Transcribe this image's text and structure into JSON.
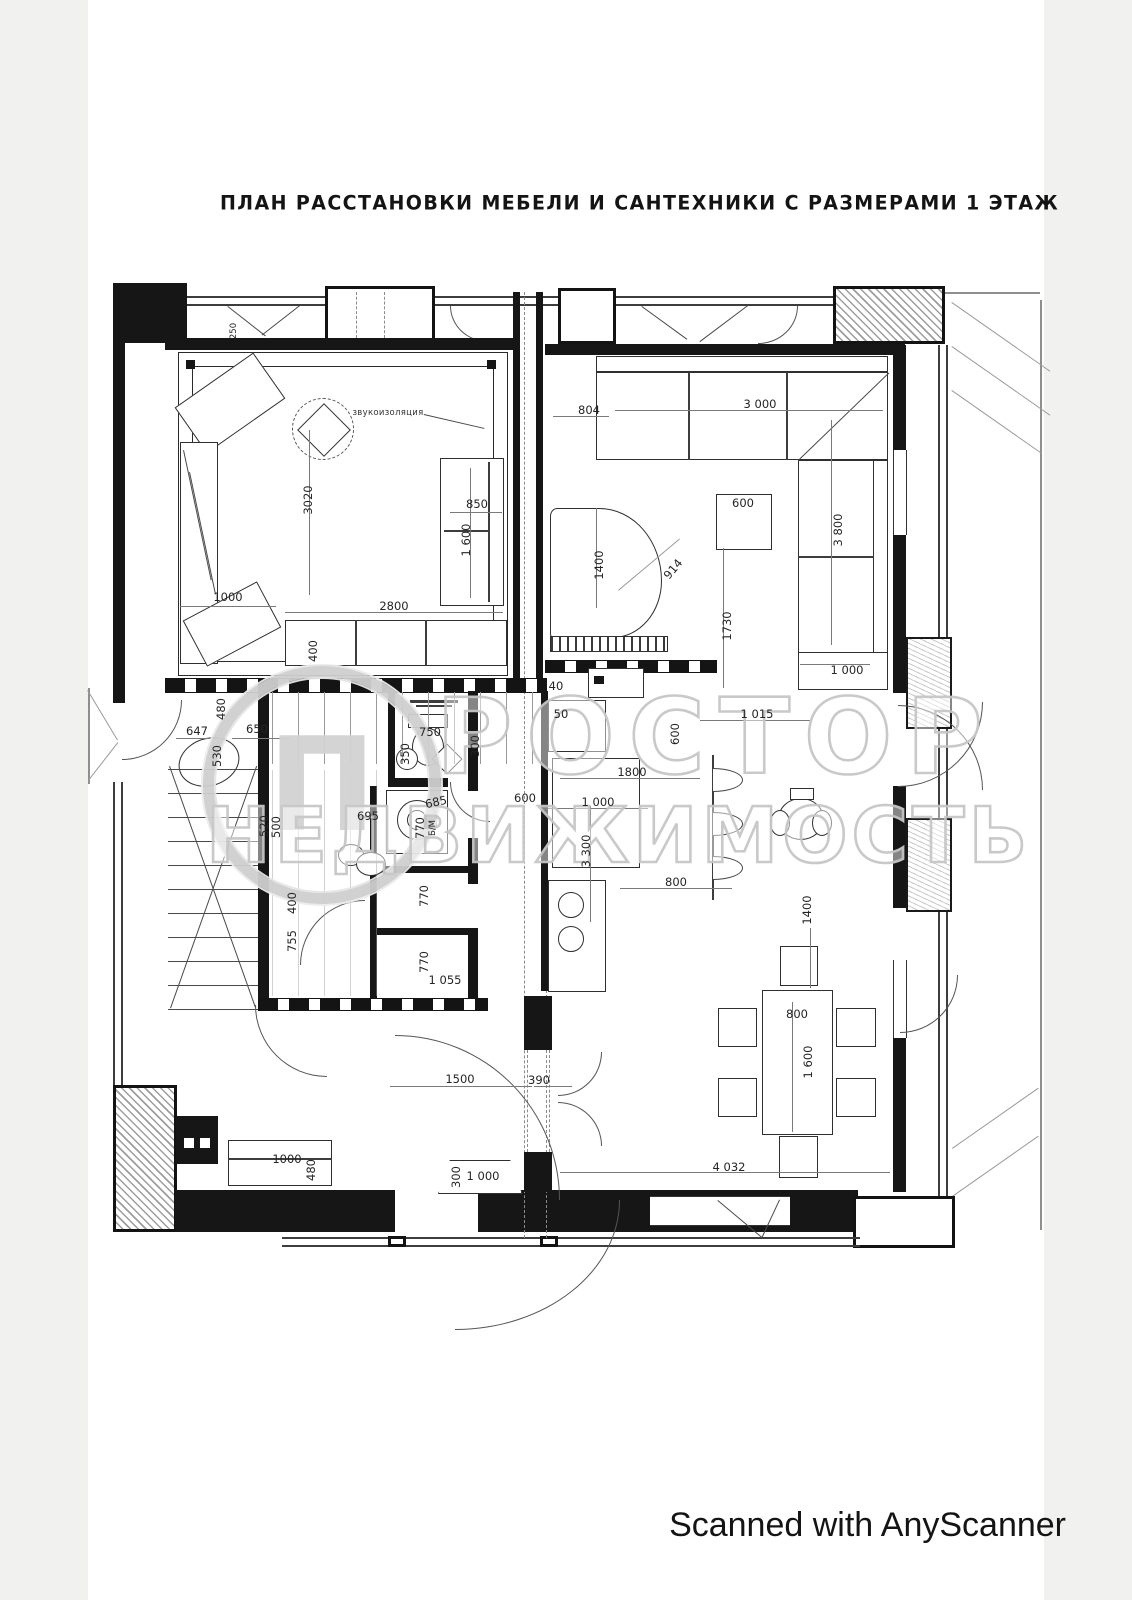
{
  "page": {
    "title": "ПЛАН РАССТАНОВКИ МЕБЕЛИ И САНТЕХНИКИ С РАЗМЕРАМИ 1 ЭТАЖ",
    "footer": "Scanned with AnyScanner"
  },
  "watermark": {
    "brand": "ПРОСТОР НЕДВИЖИМОСТЬ",
    "logo_letter": "П",
    "line1": "РОСТОР",
    "line2": "НЕДВИЖИМОСТЬ"
  },
  "plan": {
    "floor_note": "1 ЭТАЖ",
    "labels": [
      {
        "t": "250",
        "x": 234,
        "y": 331,
        "r": -90,
        "cls": "sm"
      },
      {
        "t": "звукоизоляция",
        "x": 388,
        "y": 413,
        "r": 0,
        "cls": "note"
      },
      {
        "t": "3020",
        "x": 308,
        "y": 500,
        "r": -90
      },
      {
        "t": "1000",
        "x": 228,
        "y": 597,
        "r": 0
      },
      {
        "t": "2800",
        "x": 394,
        "y": 606,
        "r": 0
      },
      {
        "t": "850",
        "x": 477,
        "y": 504,
        "r": 0
      },
      {
        "t": "1 600",
        "x": 466,
        "y": 540,
        "r": -90
      },
      {
        "t": "400",
        "x": 313,
        "y": 651,
        "r": -90
      },
      {
        "t": "804",
        "x": 589,
        "y": 410,
        "r": 0
      },
      {
        "t": "3 000",
        "x": 760,
        "y": 404,
        "r": 0
      },
      {
        "t": "600",
        "x": 743,
        "y": 503,
        "r": 0
      },
      {
        "t": "3 800",
        "x": 838,
        "y": 530,
        "r": -90
      },
      {
        "t": "1400",
        "x": 599,
        "y": 565,
        "r": -90
      },
      {
        "t": "914",
        "x": 673,
        "y": 569,
        "r": -50
      },
      {
        "t": "1730",
        "x": 727,
        "y": 626,
        "r": -90
      },
      {
        "t": "1 000",
        "x": 847,
        "y": 670,
        "r": 0
      },
      {
        "t": "40",
        "x": 556,
        "y": 686,
        "r": 0
      },
      {
        "t": "50",
        "x": 561,
        "y": 714,
        "r": 0
      },
      {
        "t": "1 015",
        "x": 757,
        "y": 714,
        "r": 0
      },
      {
        "t": "647",
        "x": 197,
        "y": 731,
        "r": 0
      },
      {
        "t": "480",
        "x": 221,
        "y": 709,
        "r": -90
      },
      {
        "t": "650",
        "x": 257,
        "y": 729,
        "r": 0
      },
      {
        "t": "530",
        "x": 217,
        "y": 756,
        "r": -90
      },
      {
        "t": "750",
        "x": 430,
        "y": 732,
        "r": 0
      },
      {
        "t": "350",
        "x": 405,
        "y": 754,
        "r": -90
      },
      {
        "t": "300",
        "x": 475,
        "y": 746,
        "r": -90
      },
      {
        "t": "600",
        "x": 525,
        "y": 798,
        "r": 0
      },
      {
        "t": "685",
        "x": 436,
        "y": 802,
        "r": -12
      },
      {
        "t": "770",
        "x": 420,
        "y": 828,
        "r": -90
      },
      {
        "t": "Б/М",
        "x": 433,
        "y": 828,
        "r": -90,
        "cls": "sm"
      },
      {
        "t": "695",
        "x": 368,
        "y": 816,
        "r": 0
      },
      {
        "t": "520",
        "x": 264,
        "y": 826,
        "r": -90
      },
      {
        "t": "500",
        "x": 276,
        "y": 827,
        "r": -90
      },
      {
        "t": "600",
        "x": 675,
        "y": 734,
        "r": -90
      },
      {
        "t": "1800",
        "x": 632,
        "y": 772,
        "r": 0
      },
      {
        "t": "1 000",
        "x": 598,
        "y": 802,
        "r": 0
      },
      {
        "t": "3 300",
        "x": 586,
        "y": 851,
        "r": -90
      },
      {
        "t": "800",
        "x": 676,
        "y": 882,
        "r": 0
      },
      {
        "t": "1400",
        "x": 807,
        "y": 910,
        "r": -90
      },
      {
        "t": "400",
        "x": 292,
        "y": 903,
        "r": -90
      },
      {
        "t": "755",
        "x": 292,
        "y": 941,
        "r": -90
      },
      {
        "t": "770",
        "x": 424,
        "y": 896,
        "r": -90
      },
      {
        "t": "770",
        "x": 424,
        "y": 962,
        "r": -90
      },
      {
        "t": "1 055",
        "x": 445,
        "y": 980,
        "r": 0
      },
      {
        "t": "800",
        "x": 797,
        "y": 1014,
        "r": 0
      },
      {
        "t": "1 600",
        "x": 808,
        "y": 1062,
        "r": -90
      },
      {
        "t": "1500",
        "x": 460,
        "y": 1079,
        "r": 0
      },
      {
        "t": "390",
        "x": 539,
        "y": 1080,
        "r": 0
      },
      {
        "t": "1000",
        "x": 287,
        "y": 1159,
        "r": 0
      },
      {
        "t": "480",
        "x": 311,
        "y": 1170,
        "r": -90
      },
      {
        "t": "300",
        "x": 456,
        "y": 1177,
        "r": -90
      },
      {
        "t": "1 000",
        "x": 483,
        "y": 1176,
        "r": 0
      },
      {
        "t": "4 032",
        "x": 729,
        "y": 1167,
        "r": 0
      }
    ]
  }
}
